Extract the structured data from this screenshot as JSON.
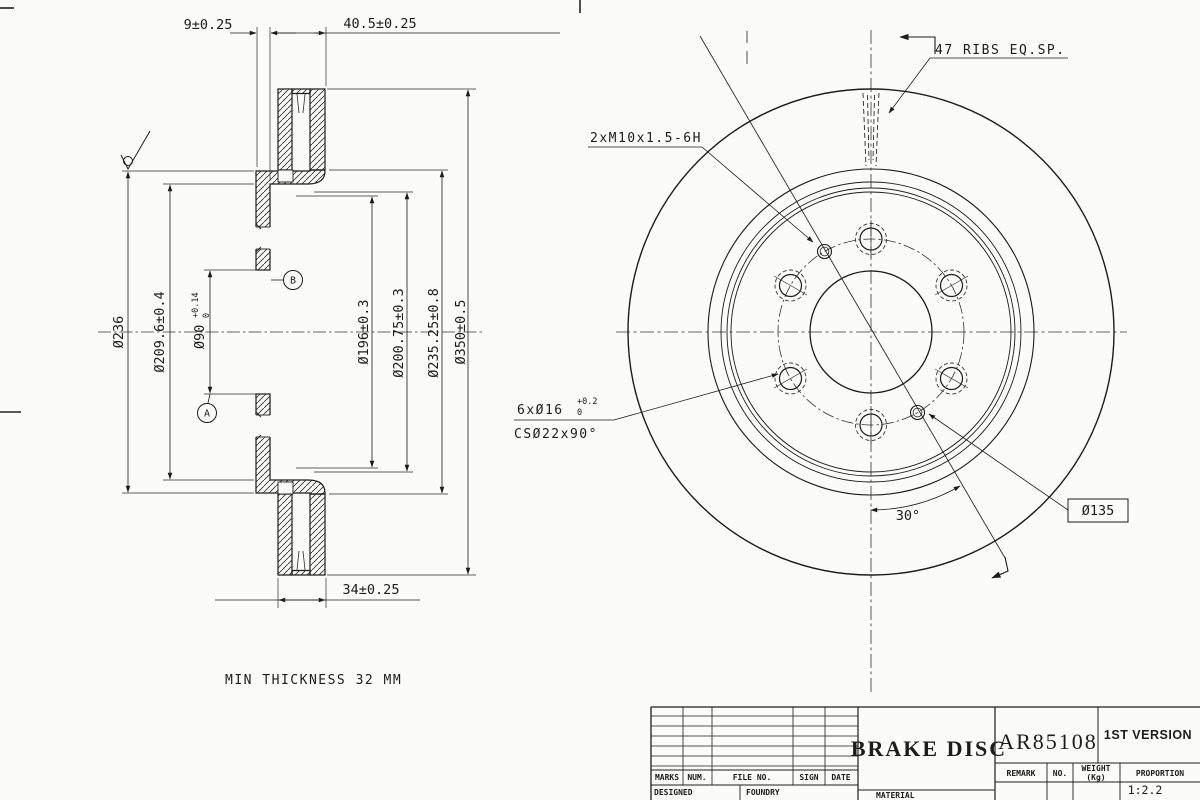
{
  "section_view": {
    "dim_top_left": "9±0.25",
    "dim_top_right": "40.5±0.25",
    "dia_236": "Ø236",
    "dia_209_6": "Ø209.6±0.4",
    "dia_90": "Ø90",
    "dia_90_tol_upper": "+0.14",
    "dia_90_tol_lower": "0",
    "dia_196": "Ø196±0.3",
    "dia_200_75": "Ø200.75±0.3",
    "dia_235_25": "Ø235.25±0.8",
    "dia_350": "Ø350±0.5",
    "dim_bottom": "34±0.25",
    "datum_a": "A",
    "datum_b": "B",
    "note_min_thickness": "MIN THICKNESS 32 MM"
  },
  "front_view": {
    "note_ribs": "47 RIBS EQ.SP.",
    "note_thread": "2xM10x1.5-6H",
    "note_holes": "6xØ16",
    "holes_tol_upper": "+0.2",
    "holes_tol_lower": "0",
    "note_countersink": "CSØ22x90°",
    "dim_angle": "30°",
    "dim_bolt_circle": "Ø135"
  },
  "title_block": {
    "title": "BRAKE DISC",
    "drawing_number": "AR85108",
    "version": "1ST VERSION",
    "columns": [
      "MARKS",
      "NUM.",
      "FILE NO.",
      "SIGN",
      "DATE"
    ],
    "designed_label": "DESIGNED",
    "foundry_label": "FOUNDRY",
    "material_label": "MATERIAL",
    "remark_label": "REMARK",
    "no_label": "NO.",
    "weight_label": "WEIGHT",
    "weight_unit": "(Kg)",
    "proportion_label": "PROPORTION",
    "proportion_value": "1:2.2"
  }
}
